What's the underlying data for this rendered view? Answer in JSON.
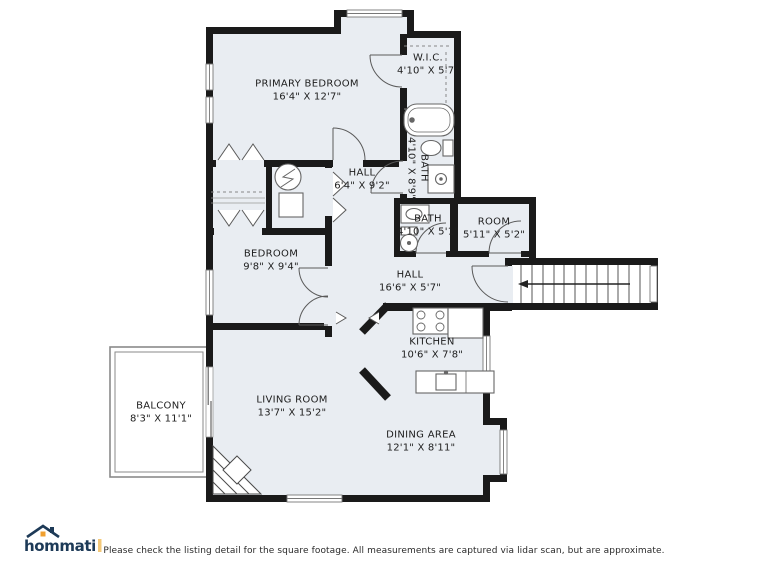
{
  "floorplan": {
    "rooms": {
      "primary_bedroom": {
        "name": "PRIMARY BEDROOM",
        "dims": "16'4\" X 12'7\""
      },
      "wic": {
        "name": "W.I.C.",
        "dims": "4'10\" X 5'7\""
      },
      "bath_primary": {
        "name": "BATH",
        "dims": "4'10\" X 8'9\""
      },
      "hall_upper": {
        "name": "HALL",
        "dims": "6'4\" X 9'2\""
      },
      "bath_hall": {
        "name": "BATH",
        "dims": "4'10\" X 5'1\""
      },
      "room_small": {
        "name": "ROOM",
        "dims": "5'11\" X 5'2\""
      },
      "bedroom": {
        "name": "BEDROOM",
        "dims": "9'8\" X 9'4\""
      },
      "hall_lower": {
        "name": "HALL",
        "dims": "16'6\" X 5'7\""
      },
      "kitchen": {
        "name": "KITCHEN",
        "dims": "10'6\" X 7'8\""
      },
      "living_room": {
        "name": "LIVING ROOM",
        "dims": "13'7\" X 15'2\""
      },
      "dining_area": {
        "name": "DINING AREA",
        "dims": "12'1\" X 8'11\""
      },
      "balcony": {
        "name": "BALCONY",
        "dims": "8'3\" X 11'1\""
      }
    }
  },
  "footer": {
    "brand": "hommati",
    "disclaimer": "Please check the listing detail for the square footage. All measurements are captured via lidar scan, but are approximate."
  },
  "colors": {
    "wall": "#1a1a1a",
    "room_fill": "#e9edf2",
    "brand_navy": "#1d3a57",
    "brand_orange": "#f0a030"
  }
}
